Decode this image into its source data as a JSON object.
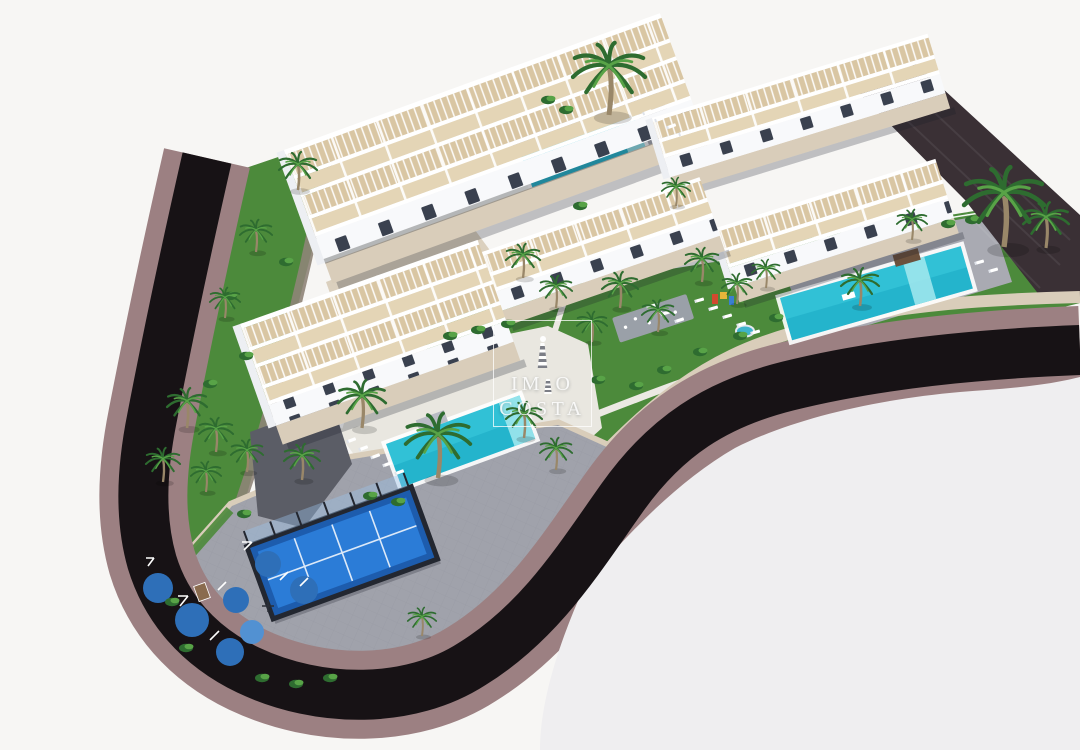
{
  "title": "Aerial 3D render of a coastal residential complex",
  "watermark": {
    "line1_left": "IM",
    "line1_right": "O",
    "line2": "COSTA"
  },
  "palette": {
    "bg": "#f7f6f4",
    "bg2": "#efeef0",
    "road": "#171215",
    "sidewalk": "#9c8082",
    "curb": "#d9cdba",
    "stone": "#8e8478",
    "wall-dark": "#3a3035",
    "lawn": "#4c8a3b",
    "lawn-dark": "#2e6a2d",
    "plaza": "#a0a2ab",
    "plaza-line": "#8e909a",
    "pool": "#31c1d6",
    "pool-deep": "#17a5c2",
    "pool-light": "#a5e9ef",
    "deck": "#a9aab2",
    "deck-light": "#e9e7e0",
    "bldg": "#ffffff",
    "bldg-cap": "#edeff3",
    "facade": "#f8f9fb",
    "floor": "#d9c6a3",
    "floor2": "#e4d5b6",
    "win": "#3a414f",
    "court": "#2b7cd7",
    "court-dark": "#1d5cad",
    "fence": "#232730",
    "pad": "#2e6fb8",
    "pad-light": "#5291d2",
    "palm1": "#2e6c30",
    "palm2": "#58a347",
    "trunk": "#998769",
    "drive": "#5b5d66",
    "shadow": "rgba(24,27,38,0.25)",
    "wm": "rgba(255,255,255,0.85)"
  },
  "scene": {
    "elements": [
      "apartment-block x5 (white terraced buildings with rooftop pergolas)",
      "swimming-pool x3 (turquoise)",
      "padel-court (blue, dark fence)",
      "children-playground (blue rubber pads, fitness equipment)",
      "splash-pad",
      "kids-play-structure",
      "perimeter-road (dark asphalt with mauve sidewalks)",
      "stone-retaining-walls",
      "palm-trees",
      "lawns-and-gardens",
      "sun-loungers",
      "paved-plaza"
    ]
  }
}
